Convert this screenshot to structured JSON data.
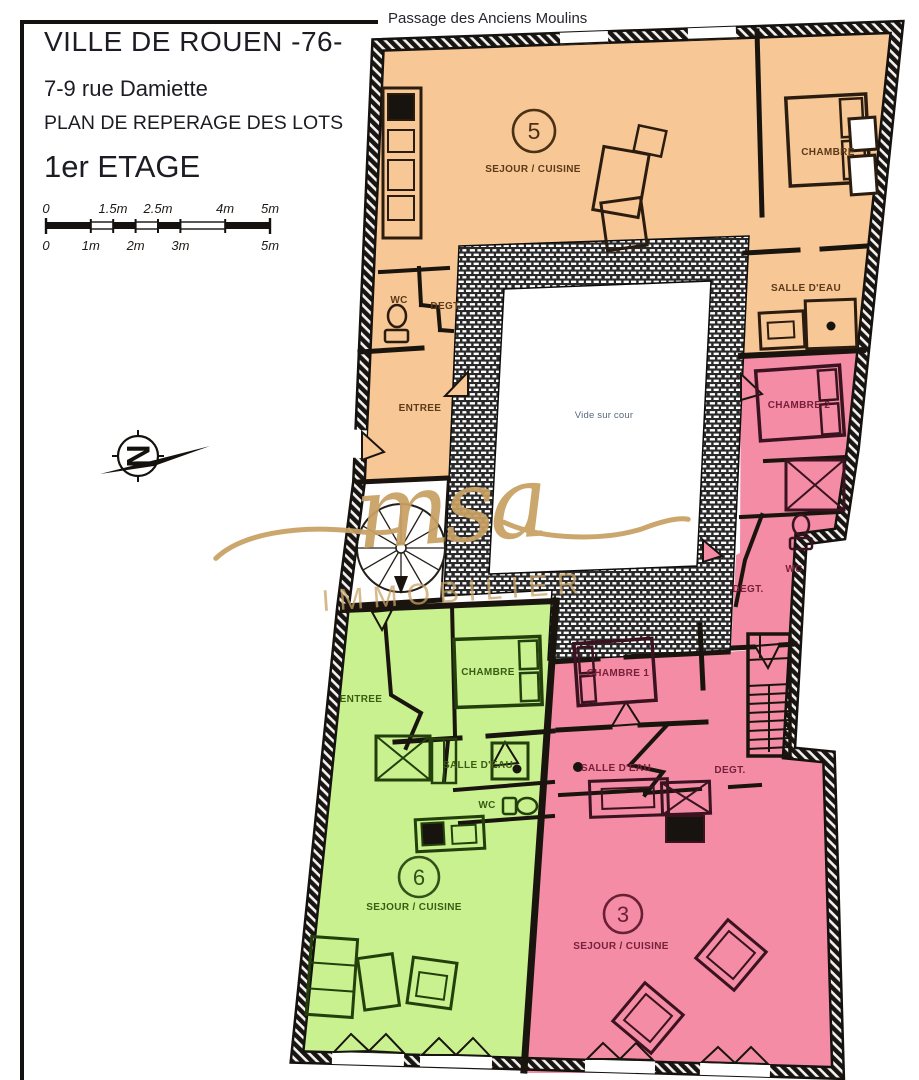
{
  "page": {
    "street_label": "Passage des Anciens Moulins"
  },
  "title_block": {
    "city": "VILLE DE ROUEN -76-",
    "address": "7-9 rue Damiette",
    "plan_title": "PLAN DE REPERAGE DES LOTS",
    "floor": "1er ETAGE"
  },
  "scale_bar": {
    "top_labels": [
      "0",
      "1.5m",
      "2.5m",
      "4m",
      "5m"
    ],
    "bottom_labels": [
      "0",
      "1m",
      "2m",
      "3m",
      "5m"
    ]
  },
  "compass": {
    "letter": "N"
  },
  "watermark": {
    "script": "msa",
    "caps": "IMMOBILIER"
  },
  "colors": {
    "lot5": "#f7c795",
    "lot3": "#f38ca4",
    "lot6": "#c9f18f",
    "gold": "#c8a164",
    "ink": "#1a140e"
  },
  "plan": {
    "courtyard_label": "Vide sur cour",
    "lot5": {
      "number": "5",
      "sejour": "SEJOUR / CUISINE",
      "chambre": "CHAMBRE",
      "salle_eau": "SALLE D'EAU",
      "wc": "WC",
      "degt": "DEGT.",
      "entree": "ENTREE"
    },
    "lot3": {
      "number": "3",
      "chambre1": "CHAMBRE 1",
      "chambre2": "CHAMBRE 2",
      "salle_eau": "SALLE D'EAU",
      "wc": "WC",
      "degt_upper": "DEGT.",
      "degt_lower": "DEGT.",
      "sejour": "SEJOUR / CUISINE"
    },
    "lot6": {
      "number": "6",
      "entree": "ENTREE",
      "chambre": "CHAMBRE",
      "salle_eau": "SALLE D'EAU",
      "wc": "WC",
      "sejour": "SEJOUR / CUISINE"
    }
  }
}
